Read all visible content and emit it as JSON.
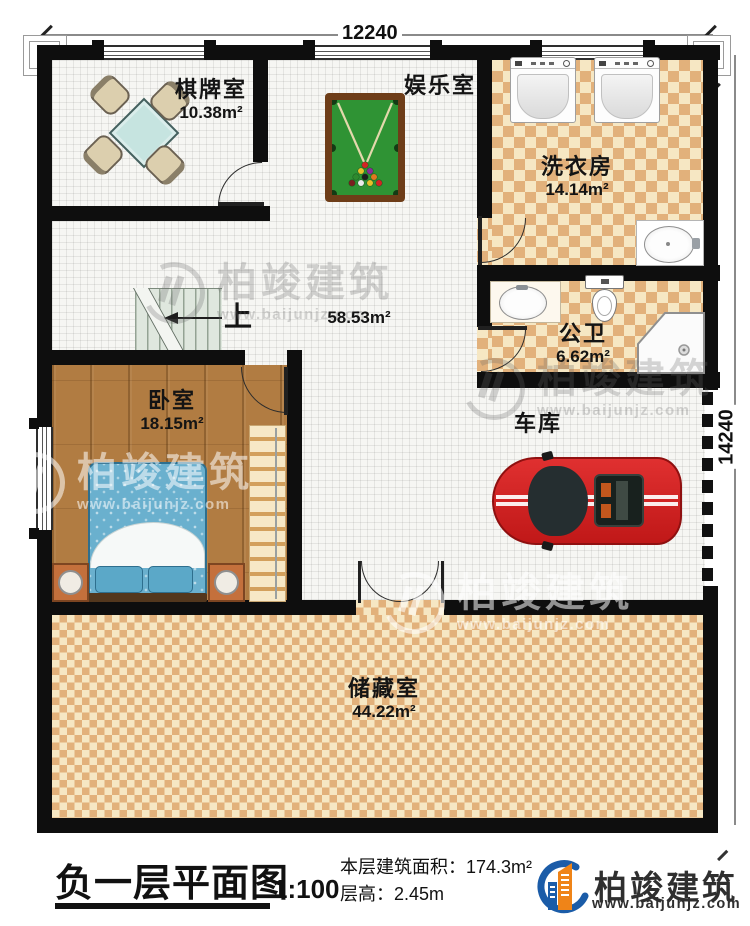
{
  "dimensions": {
    "top": "12240",
    "right": "14240"
  },
  "rooms": {
    "chess": {
      "name": "棋牌室",
      "area": "10.38m²"
    },
    "entertainment": {
      "name": "娱乐室"
    },
    "laundry": {
      "name": "洗衣房",
      "area": "14.14m²"
    },
    "hall": {
      "area": "58.53m²"
    },
    "bath": {
      "name": "公卫",
      "area": "6.62m²"
    },
    "bedroom": {
      "name": "卧室",
      "area": "18.15m²"
    },
    "garage": {
      "name": "车库"
    },
    "storage": {
      "name": "储藏室",
      "area": "44.22m²"
    }
  },
  "stairs": {
    "up_label": "上"
  },
  "footer": {
    "title": "负一层平面图",
    "scale": "1:100",
    "area_line": "本层建筑面积：174.3m²",
    "height_line": "层高：2.45m"
  },
  "brand": {
    "name": "柏竣建筑",
    "website": "www.baijunjz.com"
  },
  "watermark": {
    "name": "柏竣建筑",
    "website": "www.baijunjz.com"
  },
  "colors": {
    "wall": "#0e0e0e",
    "checker_tan": "#e2b17b",
    "wood": "#b17c42",
    "pool_green": "#2f9334",
    "car_red": "#cf1f1f",
    "bed_blue": "#6ab0ce",
    "brand_blue": "#1b5ca8",
    "brand_orange": "#ef8418"
  }
}
